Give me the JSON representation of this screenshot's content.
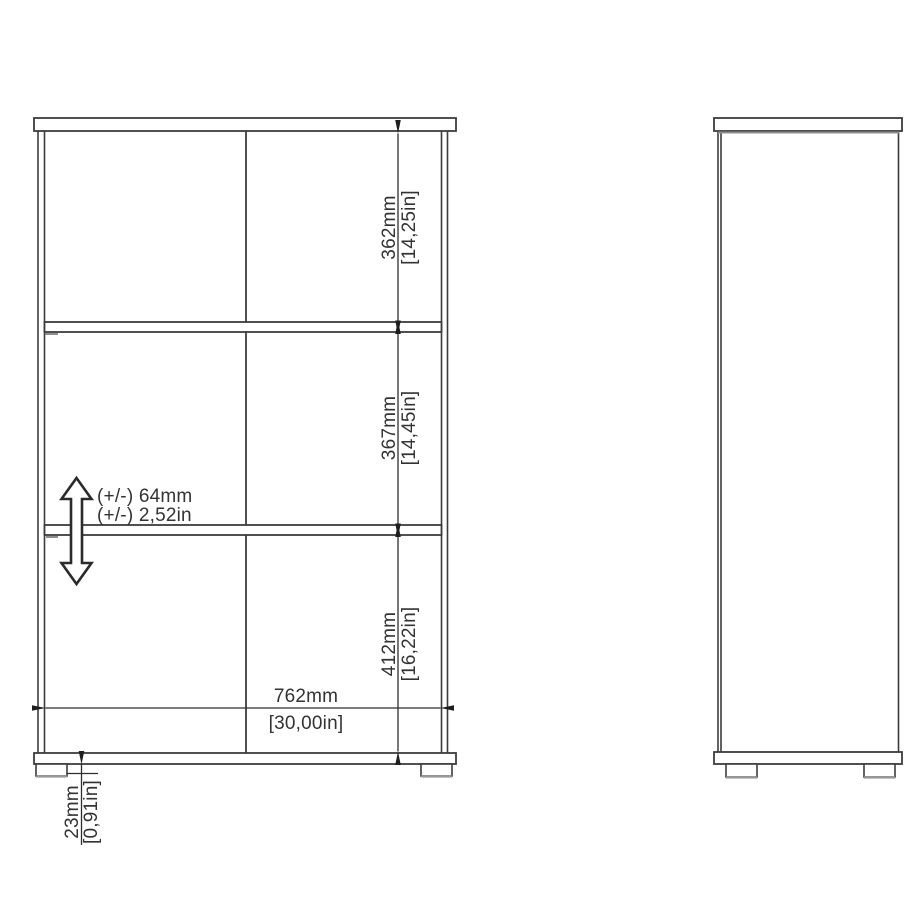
{
  "drawing_type": "furniture-dimension-diagram",
  "front_view": {
    "compartment_heights": [
      {
        "mm": "362mm",
        "inches": "[14,25in]"
      },
      {
        "mm": "367mm",
        "inches": "[14,45in]"
      },
      {
        "mm": "412mm",
        "inches": "[16,22in]"
      }
    ],
    "inner_width": {
      "mm": "762mm",
      "inches": "[30,00in]"
    },
    "foot_height": {
      "mm": "23mm",
      "inches": "[0,91in]"
    },
    "shelf_adjustability": {
      "mm": "(+/-) 64mm",
      "inches": "(+/-) 2,52in"
    }
  },
  "colors": {
    "background": "#ffffff",
    "line": "#3c3c3c",
    "dimension_line": "#2e2e2e",
    "text": "#333333",
    "arrow_fill": "#1f1f1f",
    "shade_gray": "#9a9a9a"
  }
}
